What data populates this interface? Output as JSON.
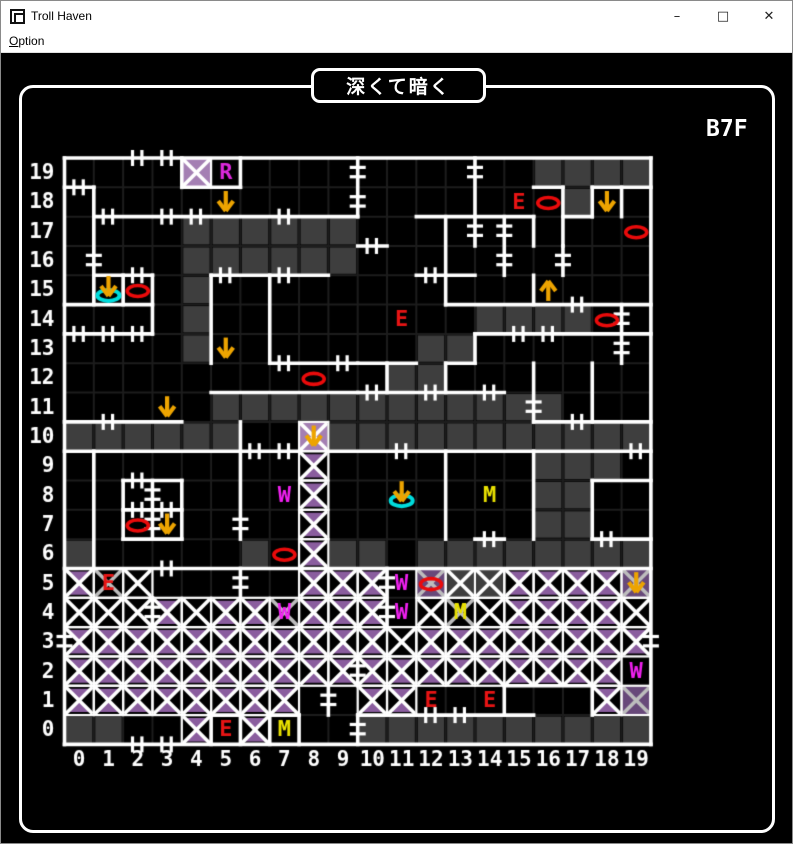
{
  "window": {
    "title": "Troll Haven",
    "minimize": "–",
    "maximize": "□",
    "close": "✕"
  },
  "menu": {
    "items": [
      {
        "label": "Option"
      }
    ]
  },
  "map": {
    "title": "深くて暗く",
    "floor": "B7F",
    "origin_x": 63.5,
    "origin_y": 105,
    "cell": 29.32,
    "cols": 20,
    "rows": 20,
    "row_labels": [
      "19",
      "18",
      "17",
      "16",
      "15",
      "14",
      "13",
      "12",
      "11",
      "10",
      "9",
      "8",
      "7",
      "6",
      "5",
      "4",
      "3",
      "2",
      "1",
      "0"
    ],
    "col_labels": [
      "0",
      "1",
      "2",
      "3",
      "4",
      "5",
      "6",
      "7",
      "8",
      "9",
      "10",
      "11",
      "12",
      "13",
      "14",
      "15",
      "16",
      "17",
      "18",
      "19"
    ],
    "colors": {
      "wall": "#ffffff",
      "grid": "#1d1d1d",
      "dark": "#3e3e3e",
      "purpleLight": "#a47fb3",
      "purpleDark": "#68497a",
      "purpleTri": "#8a5d9e",
      "xWhite": "#ffffff",
      "xGray": "#bdbdbd",
      "red": "#e81414",
      "yellow": "#e8e000",
      "magenta": "#f020f0",
      "magentaR": "#dc28dc",
      "orange": "#eda400",
      "cyan": "#00dcdc",
      "oval": "#ea0b0b"
    },
    "dark_cells": {
      "19": [
        16,
        17,
        18,
        19
      ],
      "18": [
        17
      ],
      "17": [
        4,
        5,
        6,
        7,
        8,
        9
      ],
      "16": [
        4,
        5,
        6,
        7,
        8,
        9
      ],
      "15": [
        4
      ],
      "14": [
        4,
        14,
        15,
        16,
        17
      ],
      "13": [
        4,
        12,
        13
      ],
      "12": [
        11,
        12
      ],
      "11": [
        5,
        6,
        7,
        8,
        9,
        10,
        11,
        12,
        13,
        14,
        15,
        16
      ],
      "10": [
        0,
        1,
        2,
        3,
        4,
        5,
        9,
        10,
        11,
        12,
        13,
        14,
        15,
        16,
        17,
        18,
        19
      ],
      "9": [
        16,
        17,
        18
      ],
      "8": [
        16,
        17
      ],
      "7": [
        16,
        17
      ],
      "6": [
        0,
        6,
        9,
        10,
        12,
        13,
        14,
        15,
        16,
        17,
        18,
        19
      ],
      "0": [
        0,
        1,
        10,
        11,
        12,
        13,
        14,
        15,
        16,
        17,
        18,
        19
      ]
    },
    "x_cells": [
      [
        4,
        19,
        "wp"
      ],
      [
        8,
        10,
        "wp"
      ],
      [
        8,
        9,
        "wt"
      ],
      [
        8,
        8,
        "wt"
      ],
      [
        8,
        7,
        "wt"
      ],
      [
        8,
        6,
        "wt"
      ],
      [
        0,
        5,
        "wt"
      ],
      [
        1,
        5,
        "gk"
      ],
      [
        2,
        5,
        "wk"
      ],
      [
        8,
        5,
        "wt"
      ],
      [
        9,
        5,
        "wt"
      ],
      [
        10,
        5,
        "wt"
      ],
      [
        12,
        5,
        "gp"
      ],
      [
        13,
        5,
        "wd"
      ],
      [
        14,
        5,
        "wd"
      ],
      [
        15,
        5,
        "wt"
      ],
      [
        16,
        5,
        "wt"
      ],
      [
        17,
        5,
        "wt"
      ],
      [
        18,
        5,
        "wt"
      ],
      [
        19,
        5,
        "gp"
      ],
      [
        0,
        4,
        "wk"
      ],
      [
        1,
        4,
        "wk"
      ],
      [
        2,
        4,
        "wk"
      ],
      [
        3,
        4,
        "wt"
      ],
      [
        4,
        4,
        "wk"
      ],
      [
        5,
        4,
        "wt"
      ],
      [
        6,
        4,
        "wt"
      ],
      [
        7,
        4,
        "gk"
      ],
      [
        8,
        4,
        "wt"
      ],
      [
        9,
        4,
        "wt"
      ],
      [
        10,
        4,
        "wt"
      ],
      [
        12,
        4,
        "wk"
      ],
      [
        13,
        4,
        "gk"
      ],
      [
        14,
        4,
        "wk"
      ],
      [
        15,
        4,
        "wt"
      ],
      [
        16,
        4,
        "wt"
      ],
      [
        17,
        4,
        "wt"
      ],
      [
        18,
        4,
        "wt"
      ],
      [
        19,
        4,
        "wk"
      ],
      [
        0,
        3,
        "wt"
      ],
      [
        1,
        3,
        "wt"
      ],
      [
        2,
        3,
        "wt"
      ],
      [
        3,
        3,
        "wt"
      ],
      [
        4,
        3,
        "wt"
      ],
      [
        5,
        3,
        "wt"
      ],
      [
        6,
        3,
        "wt"
      ],
      [
        7,
        3,
        "wt"
      ],
      [
        8,
        3,
        "wt"
      ],
      [
        9,
        3,
        "wt"
      ],
      [
        10,
        3,
        "wt"
      ],
      [
        11,
        3,
        "wk"
      ],
      [
        12,
        3,
        "wt"
      ],
      [
        13,
        3,
        "wt"
      ],
      [
        14,
        3,
        "wt"
      ],
      [
        15,
        3,
        "wt"
      ],
      [
        16,
        3,
        "wt"
      ],
      [
        17,
        3,
        "wt"
      ],
      [
        18,
        3,
        "wt"
      ],
      [
        19,
        3,
        "wt"
      ],
      [
        0,
        2,
        "wt"
      ],
      [
        1,
        2,
        "wt"
      ],
      [
        2,
        2,
        "wt"
      ],
      [
        3,
        2,
        "wt"
      ],
      [
        4,
        2,
        "wt"
      ],
      [
        5,
        2,
        "wt"
      ],
      [
        6,
        2,
        "wt"
      ],
      [
        7,
        2,
        "wt"
      ],
      [
        8,
        2,
        "wt"
      ],
      [
        9,
        2,
        "wt"
      ],
      [
        10,
        2,
        "wt"
      ],
      [
        11,
        2,
        "wt"
      ],
      [
        12,
        2,
        "wt"
      ],
      [
        13,
        2,
        "wt"
      ],
      [
        14,
        2,
        "wt"
      ],
      [
        15,
        2,
        "wt"
      ],
      [
        16,
        2,
        "wt"
      ],
      [
        17,
        2,
        "wt"
      ],
      [
        18,
        2,
        "wt"
      ],
      [
        0,
        1,
        "wt"
      ],
      [
        1,
        1,
        "wt"
      ],
      [
        2,
        1,
        "wt"
      ],
      [
        3,
        1,
        "wt"
      ],
      [
        4,
        1,
        "wt"
      ],
      [
        5,
        1,
        "wt"
      ],
      [
        6,
        1,
        "wt"
      ],
      [
        7,
        1,
        "wt"
      ],
      [
        10,
        1,
        "wt"
      ],
      [
        11,
        1,
        "wt"
      ],
      [
        18,
        1,
        "wt"
      ],
      [
        19,
        1,
        "gp"
      ],
      [
        4,
        0,
        "wt"
      ],
      [
        6,
        0,
        "wt"
      ]
    ],
    "walls_h": [
      [
        19,
        0,
        19,
        [
          2,
          3
        ]
      ],
      [
        18,
        0,
        0,
        [
          0
        ]
      ],
      [
        18,
        4,
        5,
        []
      ],
      [
        18,
        16,
        16,
        []
      ],
      [
        18,
        18,
        19,
        []
      ],
      [
        17,
        1,
        9,
        [
          1,
          3,
          4,
          7
        ]
      ],
      [
        17,
        12,
        15,
        []
      ],
      [
        17,
        17,
        17,
        []
      ],
      [
        16,
        10,
        10,
        [
          10
        ]
      ],
      [
        15,
        1,
        2,
        [
          2
        ]
      ],
      [
        15,
        5,
        8,
        [
          5,
          7
        ]
      ],
      [
        15,
        12,
        13,
        [
          12
        ]
      ],
      [
        14,
        0,
        2,
        []
      ],
      [
        14,
        13,
        19,
        [
          17
        ]
      ],
      [
        13,
        0,
        2,
        [
          0,
          1,
          2
        ]
      ],
      [
        13,
        14,
        19,
        [
          15,
          16
        ]
      ],
      [
        12,
        7,
        9,
        [
          7,
          9
        ]
      ],
      [
        12,
        10,
        11,
        []
      ],
      [
        12,
        13,
        13,
        []
      ],
      [
        11,
        5,
        9,
        []
      ],
      [
        11,
        10,
        14,
        [
          10,
          12,
          14
        ]
      ],
      [
        10,
        0,
        3,
        [
          1
        ]
      ],
      [
        10,
        16,
        19,
        [
          17
        ]
      ],
      [
        9,
        0,
        7,
        [
          6,
          7
        ]
      ],
      [
        9,
        9,
        19,
        [
          11,
          19
        ]
      ],
      [
        8,
        2,
        3,
        [
          2
        ]
      ],
      [
        8,
        18,
        19,
        []
      ],
      [
        7,
        2,
        3,
        [
          2,
          3
        ]
      ],
      [
        6,
        2,
        3,
        []
      ],
      [
        6,
        14,
        14,
        [
          14
        ]
      ],
      [
        6,
        18,
        19,
        [
          18
        ]
      ],
      [
        5,
        0,
        19,
        [
          3
        ]
      ],
      [
        1,
        15,
        17,
        []
      ],
      [
        0,
        5,
        5,
        []
      ],
      [
        0,
        7,
        7,
        []
      ],
      [
        0,
        10,
        15,
        [
          12,
          13
        ]
      ],
      [
        -1,
        0,
        19,
        [
          2,
          3
        ]
      ]
    ],
    "walls_v": [
      [
        0,
        19,
        0,
        [
          3
        ]
      ],
      [
        20,
        19,
        0,
        [
          3
        ]
      ],
      [
        10,
        19,
        18,
        [
          19,
          18
        ]
      ],
      [
        4,
        19,
        19,
        []
      ],
      [
        6,
        19,
        19,
        []
      ],
      [
        14,
        19,
        18,
        [
          19
        ]
      ],
      [
        1,
        18,
        15,
        [
          16
        ]
      ],
      [
        17,
        18,
        17,
        []
      ],
      [
        18,
        18,
        18,
        []
      ],
      [
        19,
        18,
        18,
        []
      ],
      [
        13,
        17,
        15,
        []
      ],
      [
        14,
        17,
        17,
        [
          17
        ]
      ],
      [
        15,
        17,
        16,
        [
          17,
          16
        ]
      ],
      [
        16,
        17,
        17,
        []
      ],
      [
        17,
        16,
        16,
        [
          16
        ]
      ],
      [
        2,
        15,
        15,
        []
      ],
      [
        3,
        15,
        14,
        []
      ],
      [
        5,
        15,
        13,
        []
      ],
      [
        7,
        15,
        13,
        []
      ],
      [
        16,
        15,
        15,
        []
      ],
      [
        19,
        14,
        13,
        [
          14,
          13
        ]
      ],
      [
        14,
        13,
        13,
        []
      ],
      [
        11,
        12,
        12,
        []
      ],
      [
        13,
        12,
        12,
        []
      ],
      [
        16,
        12,
        11,
        [
          11
        ]
      ],
      [
        18,
        12,
        11,
        []
      ],
      [
        13,
        9,
        7,
        []
      ],
      [
        16,
        9,
        7,
        []
      ],
      [
        18,
        8,
        7,
        []
      ],
      [
        6,
        10,
        7,
        [
          7
        ]
      ],
      [
        1,
        9,
        6,
        []
      ],
      [
        2,
        8,
        7,
        []
      ],
      [
        3,
        8,
        7,
        [
          8,
          7
        ]
      ],
      [
        4,
        8,
        7,
        []
      ],
      [
        11,
        5,
        4,
        [
          5,
          4
        ]
      ],
      [
        6,
        5,
        5,
        [
          5
        ]
      ],
      [
        3,
        4,
        4,
        [
          4
        ]
      ],
      [
        10,
        2,
        2,
        [
          2
        ]
      ],
      [
        9,
        1,
        1,
        [
          1
        ]
      ],
      [
        15,
        1,
        1,
        []
      ],
      [
        18,
        1,
        1,
        []
      ],
      [
        5,
        0,
        0,
        []
      ],
      [
        6,
        0,
        0,
        []
      ],
      [
        7,
        0,
        0,
        []
      ],
      [
        8,
        0,
        0,
        []
      ],
      [
        10,
        0,
        0,
        [
          0
        ]
      ]
    ],
    "letters": [
      {
        "ch": "R",
        "x": 5,
        "y": 19,
        "color": "magentaR"
      },
      {
        "ch": "E",
        "x": 15,
        "y": 18,
        "color": "red"
      },
      {
        "ch": "E",
        "x": 11,
        "y": 14,
        "color": "red"
      },
      {
        "ch": "E",
        "x": 1,
        "y": 5,
        "color": "red"
      },
      {
        "ch": "E",
        "x": 12,
        "y": 1,
        "color": "red"
      },
      {
        "ch": "E",
        "x": 14,
        "y": 1,
        "color": "red"
      },
      {
        "ch": "E",
        "x": 5,
        "y": 0,
        "color": "red"
      },
      {
        "ch": "M",
        "x": 14,
        "y": 8,
        "color": "yellow"
      },
      {
        "ch": "M",
        "x": 13,
        "y": 4,
        "color": "yellow"
      },
      {
        "ch": "M",
        "x": 7,
        "y": 0,
        "color": "yellow"
      },
      {
        "ch": "W",
        "x": 7,
        "y": 8,
        "color": "magenta"
      },
      {
        "ch": "W",
        "x": 11,
        "y": 5,
        "color": "magenta"
      },
      {
        "ch": "W",
        "x": 11,
        "y": 4,
        "color": "magenta"
      },
      {
        "ch": "W",
        "x": 7,
        "y": 4,
        "color": "magenta"
      },
      {
        "ch": "W",
        "x": 19,
        "y": 2,
        "color": "magenta"
      }
    ],
    "arrows": [
      {
        "x": 5,
        "y": 18,
        "dir": "down"
      },
      {
        "x": 18,
        "y": 18,
        "dir": "down"
      },
      {
        "x": 16,
        "y": 15,
        "dir": "up"
      },
      {
        "x": 5,
        "y": 13,
        "dir": "down"
      },
      {
        "x": 3,
        "y": 11,
        "dir": "down"
      },
      {
        "x": 8,
        "y": 10,
        "dir": "down"
      },
      {
        "x": 3,
        "y": 7,
        "dir": "down"
      },
      {
        "x": 19,
        "y": 5,
        "dir": "down"
      }
    ],
    "chutes": [
      {
        "x": 1,
        "y": 15
      },
      {
        "x": 11,
        "y": 8
      }
    ],
    "ovals": [
      [
        2,
        15
      ],
      [
        16,
        18
      ],
      [
        19,
        17
      ],
      [
        18,
        14
      ],
      [
        8,
        12
      ],
      [
        2,
        7
      ],
      [
        7,
        6
      ],
      [
        12,
        5
      ]
    ]
  }
}
